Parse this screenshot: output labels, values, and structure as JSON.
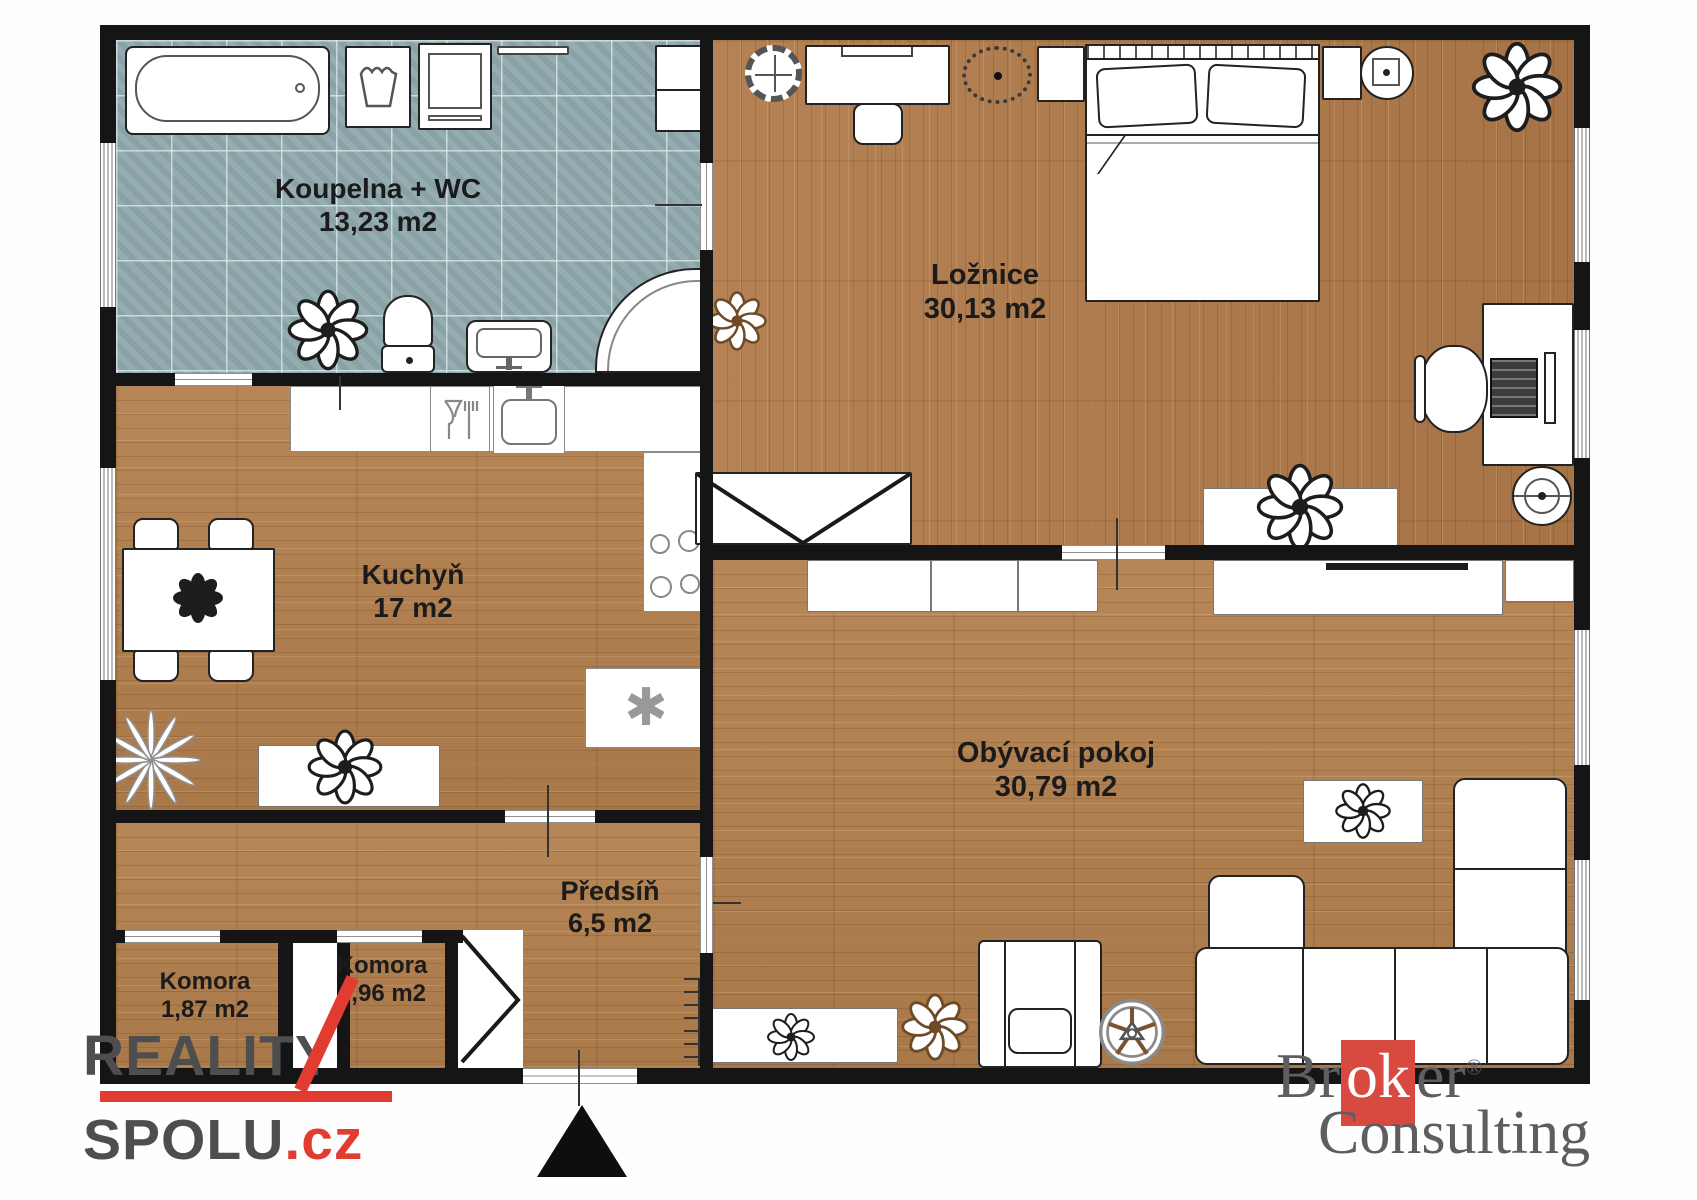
{
  "plan": {
    "rooms": [
      {
        "id": "bathroom",
        "name": "Koupelna + WC",
        "area": "13,23 m2"
      },
      {
        "id": "bedroom",
        "name": "Ložnice",
        "area": "30,13 m2"
      },
      {
        "id": "kitchen",
        "name": "Kuchyň",
        "area": "17 m2"
      },
      {
        "id": "living",
        "name": "Obývací pokoj",
        "area": "30,79 m2"
      },
      {
        "id": "hall",
        "name": "Předsíň",
        "area": "6,5 m2"
      },
      {
        "id": "storage1",
        "name": "Komora",
        "area": "1,87 m2"
      },
      {
        "id": "storage2",
        "name": "Komora",
        "area": "0,96 m2"
      }
    ],
    "north_arrow": true,
    "colors": {
      "wall": "#151515",
      "wood_floor": "#b3804e",
      "tile_floor": "#8fa9ac",
      "accent_red": "#e23b30",
      "logo_gray": "#4e4e4e",
      "broker_red": "#d8493f",
      "broker_gray": "#5d5d62"
    }
  },
  "watermarks": {
    "reality_spolu": {
      "line1": "REALITY",
      "line2": "SPOLU",
      "tld": ".cz"
    },
    "broker_consulting": {
      "w1a": "Br",
      "w1b": "ok",
      "w1c": "er",
      "registered": "®",
      "w2": "Consulting"
    }
  }
}
